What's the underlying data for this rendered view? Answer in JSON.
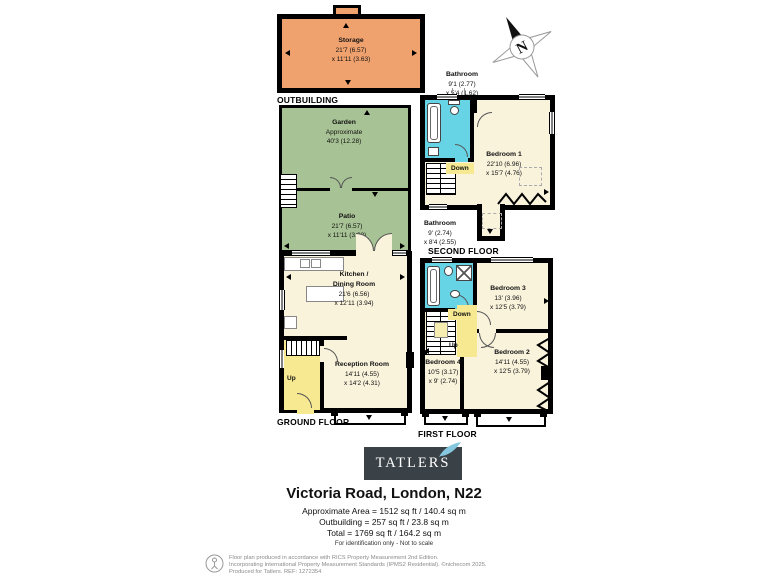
{
  "colors": {
    "wall": "#000000",
    "room": "#FAF3DC",
    "garden": "#A7C294",
    "storage": "#F0A26E",
    "bathroom": "#66D4E4",
    "stairs_highlight": "#F6E992",
    "logo_bg": "#3A4147",
    "leaf": "#85C7DE"
  },
  "compass": {
    "letter": "N"
  },
  "outbuilding": {
    "floor_label": "OUTBUILDING",
    "storage": {
      "name": "Storage",
      "dim1": "21'7 (6.57)",
      "dim2": "x 11'11 (3.63)"
    }
  },
  "ground_floor": {
    "floor_label": "GROUND FLOOR",
    "garden": {
      "name": "Garden",
      "dim1": "Approximate",
      "dim2": "40'3 (12.28)"
    },
    "patio": {
      "name": "Patio",
      "dim1": "21'7 (6.57)",
      "dim2": "x 11'11 (3.63)"
    },
    "kitchen": {
      "name1": "Kitchen /",
      "name2": "Dining Room",
      "dim1": "21'6 (6.56)",
      "dim2": "x 12'11 (3.94)"
    },
    "reception": {
      "name": "Reception Room",
      "dim1": "14'11 (4.55)",
      "dim2": "x 14'2 (4.31)"
    },
    "up_label": "Up"
  },
  "second_floor": {
    "floor_label": "SECOND FLOOR",
    "bathroom": {
      "name": "Bathroom",
      "dim1": "9'1 (2.77)",
      "dim2": "x 5'4 (1.62)"
    },
    "bedroom1": {
      "name": "Bedroom 1",
      "dim1": "22'10 (6.96)",
      "dim2": "x 15'7 (4.76)"
    },
    "down_label": "Down"
  },
  "first_floor": {
    "floor_label": "FIRST FLOOR",
    "bathroom": {
      "name": "Bathroom",
      "dim1": "9' (2.74)",
      "dim2": "x 8'4 (2.55)"
    },
    "bedroom3": {
      "name": "Bedroom 3",
      "dim1": "13' (3.96)",
      "dim2": "x 12'5 (3.79)"
    },
    "bedroom2": {
      "name": "Bedroom 2",
      "dim1": "14'11 (4.55)",
      "dim2": "x 12'5 (3.79)"
    },
    "bedroom4": {
      "name": "Bedroom 4",
      "dim1": "10'5 (3.17)",
      "dim2": "x 9' (2.74)"
    },
    "down_label": "Down",
    "up_label": "Up"
  },
  "branding": {
    "logo_text": "TATLERS"
  },
  "address": "Victoria Road, London, N22",
  "areas": {
    "line1": "Approximate Area = 1512 sq ft / 140.4 sq m",
    "line2": "Outbuilding = 257 sq ft / 23.8 sq m",
    "line3": "Total = 1769 sq ft / 164.2 sq m",
    "note": "For identification only - Not to scale"
  },
  "footer": {
    "line1": "Floor plan produced in accordance with RICS Property Measurement 2nd Edition.",
    "line2": "Incorporating International Property Measurement Standards (IPMS2 Residential).  ©nichecom 2025.",
    "line3": "Produced for Tatlers.   REF: 1272354"
  }
}
